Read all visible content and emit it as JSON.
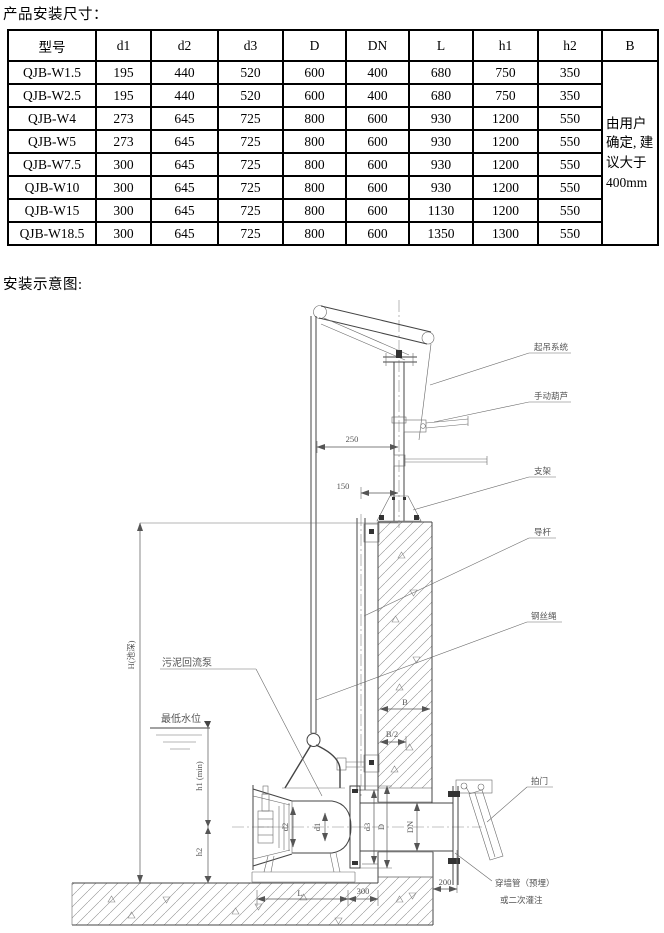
{
  "page": {
    "title_dimensions": "产品安装尺寸：",
    "title_diagram": "安装示意图:"
  },
  "table": {
    "headers": [
      "型号",
      "d1",
      "d2",
      "d3",
      "D",
      "DN",
      "L",
      "h1",
      "h2",
      "B"
    ],
    "rows": [
      [
        "QJB-W1.5",
        "195",
        "440",
        "520",
        "600",
        "400",
        "680",
        "750",
        "350"
      ],
      [
        "QJB-W2.5",
        "195",
        "440",
        "520",
        "600",
        "400",
        "680",
        "750",
        "350"
      ],
      [
        "QJB-W4",
        "273",
        "645",
        "725",
        "800",
        "600",
        "930",
        "1200",
        "550"
      ],
      [
        "QJB-W5",
        "273",
        "645",
        "725",
        "800",
        "600",
        "930",
        "1200",
        "550"
      ],
      [
        "QJB-W7.5",
        "300",
        "645",
        "725",
        "800",
        "600",
        "930",
        "1200",
        "550"
      ],
      [
        "QJB-W10",
        "300",
        "645",
        "725",
        "800",
        "600",
        "930",
        "1200",
        "550"
      ],
      [
        "QJB-W15",
        "300",
        "645",
        "725",
        "800",
        "600",
        "1130",
        "1200",
        "550"
      ],
      [
        "QJB-W18.5",
        "300",
        "645",
        "725",
        "800",
        "600",
        "1350",
        "1300",
        "550"
      ]
    ],
    "b_note": "由用户确定, 建议大于400mm"
  },
  "diagram": {
    "labels": {
      "lifting_system": "起吊系统",
      "manual_hoist": "手动葫芦",
      "bracket": "支架",
      "guide_rod": "导杆",
      "wire_rope": "钢丝绳",
      "sludge_return_pump": "污泥回流泵",
      "lowest_water_level": "最低水位",
      "flap_valve": "拍门",
      "wall_pipe": "穿墙管（预埋）",
      "or_secondary_grouting": "或二次灌注"
    },
    "dims": {
      "d250": "250",
      "d150": "150",
      "d300": "300",
      "d200": "200",
      "L": "L",
      "B": "B",
      "B_half": "B/2",
      "H": "H(池深)",
      "h1": "h1 (min)",
      "h2": "h2",
      "d1": "d1",
      "d2": "d2",
      "d3": "d3",
      "D": "D",
      "DN": "DN"
    }
  }
}
